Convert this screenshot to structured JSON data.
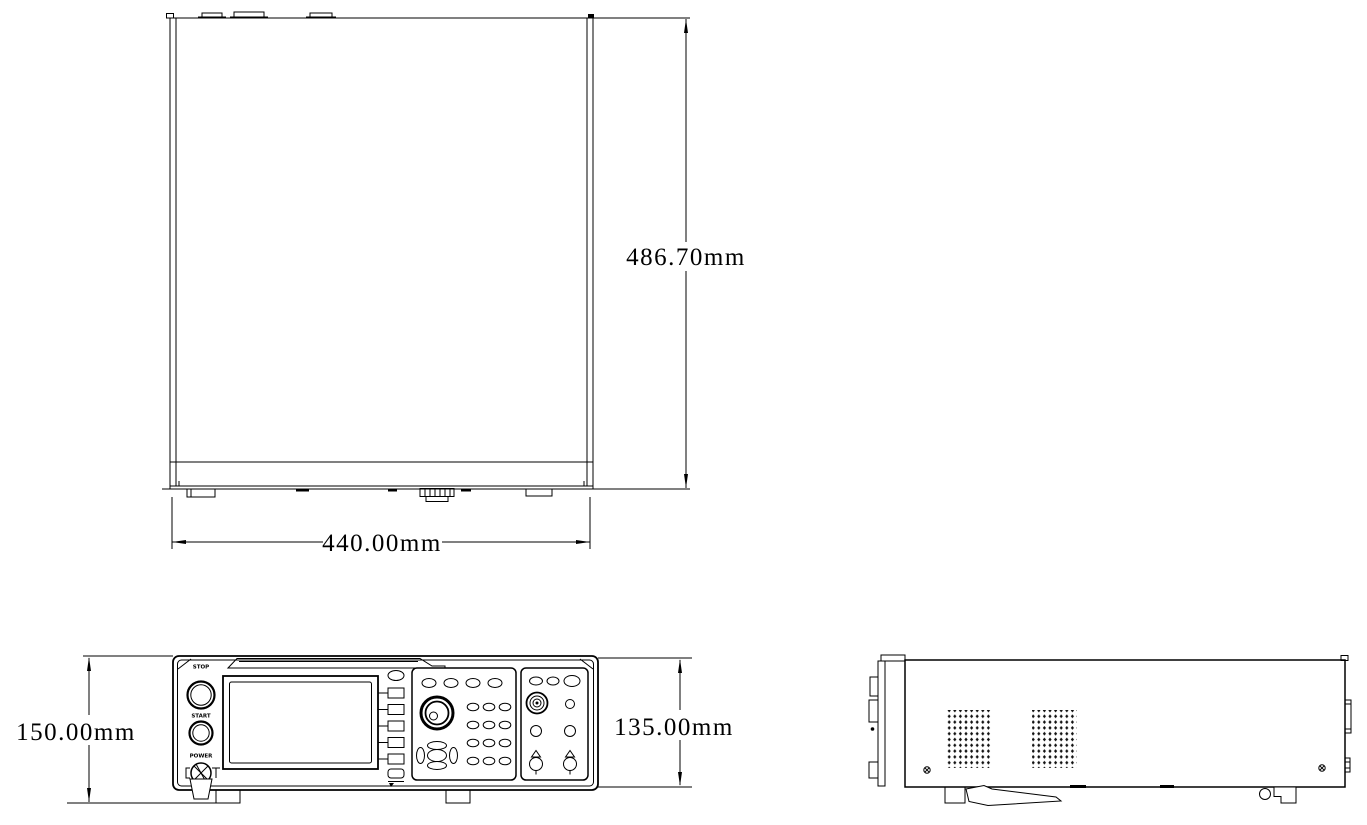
{
  "page": {
    "background": "#ffffff",
    "line_color": "#000000",
    "units": "mm"
  },
  "dimensions": {
    "top_view_height": "486.70mm",
    "top_view_width": "440.00mm",
    "front_view_height": "150.00mm",
    "front_view_body_height": "135.00mm"
  },
  "front_panel": {
    "stop_label": "STOP",
    "start_label": "START",
    "power_label": "POWER"
  }
}
